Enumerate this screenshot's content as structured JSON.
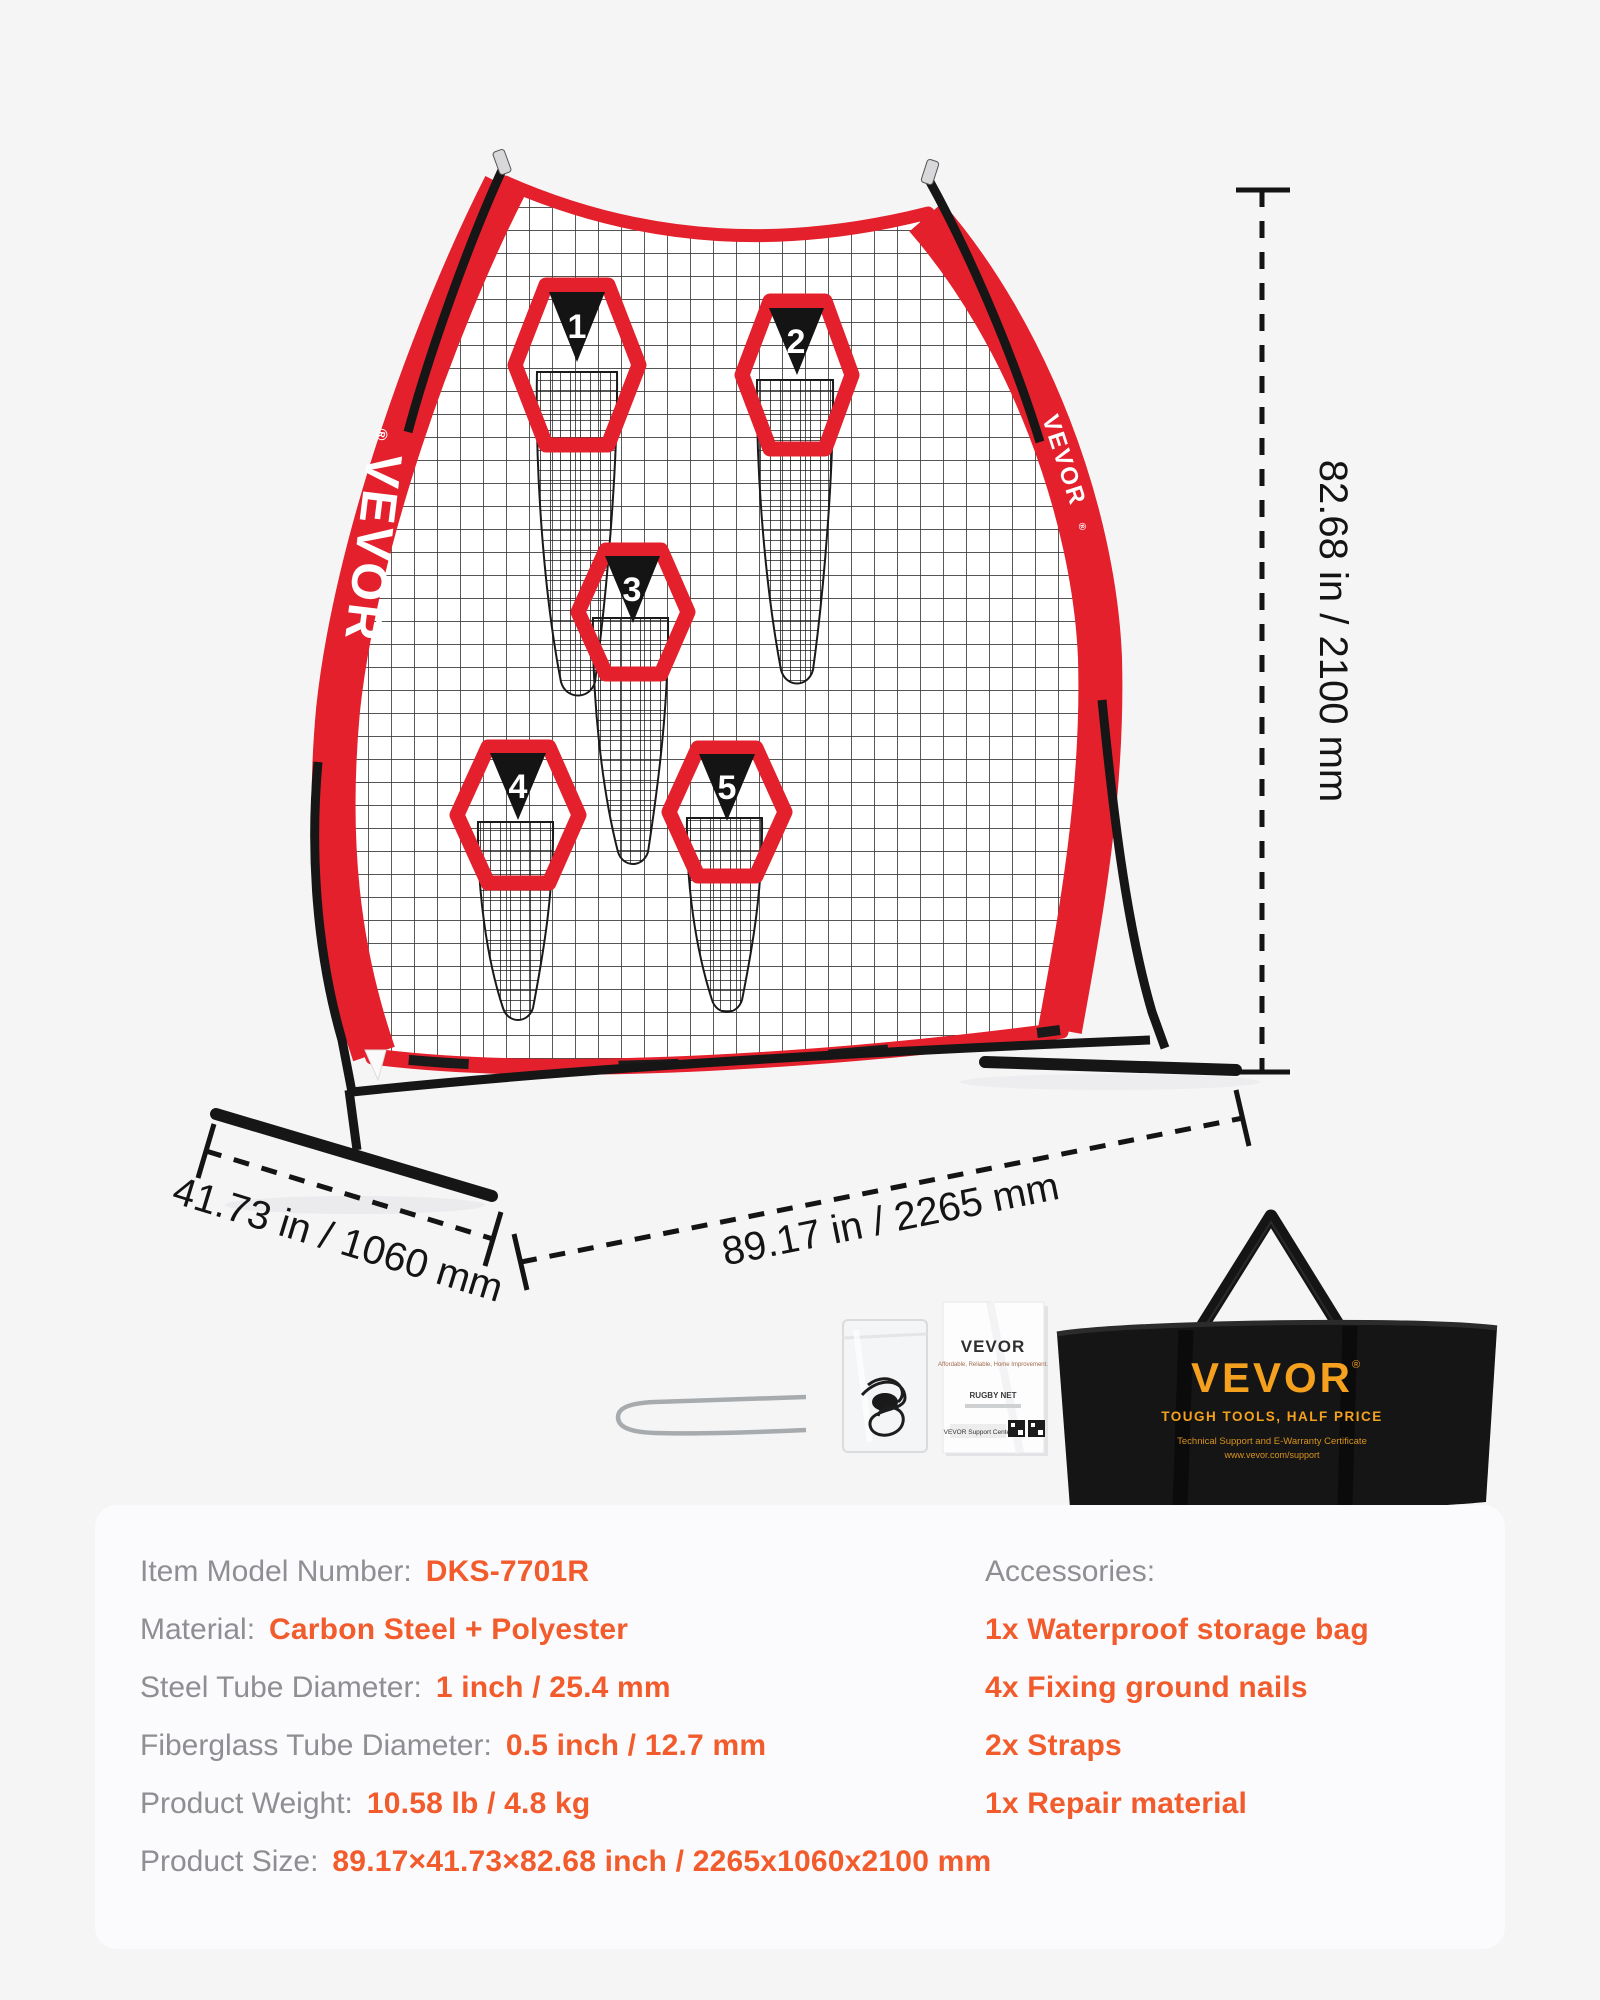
{
  "brand": {
    "name": "VEVOR",
    "registered": "®"
  },
  "net": {
    "targets": [
      "1",
      "2",
      "3",
      "4",
      "5"
    ]
  },
  "dimension_labels": {
    "height": "82.68 in / 2100 mm",
    "width": "89.17 in / 2265 mm",
    "depth": "41.73 in / 1060 mm"
  },
  "accessories_visual": {
    "manual": {
      "brand": "VEVOR",
      "tagline": "Affordable, Reliable, Home Improvement.",
      "product": "RUGBY NET",
      "support": "VEVOR Support Center"
    },
    "storage_bag": {
      "brand": "VEVOR",
      "registered": "®",
      "slogan": "TOUGH TOOLS, HALF PRICE",
      "line1": "Technical Support and E-Warranty Certificate",
      "line2": "www.vevor.com/support"
    }
  },
  "specs": {
    "rows": [
      {
        "label": "Item Model Number:",
        "value": "DKS-7701R"
      },
      {
        "label": "Material:",
        "value": "Carbon Steel + Polyester"
      },
      {
        "label": "Steel Tube Diameter:",
        "value": "1 inch / 25.4 mm"
      },
      {
        "label": "Fiberglass Tube Diameter:",
        "value": "0.5 inch / 12.7 mm"
      },
      {
        "label": "Product Weight:",
        "value": "10.58 lb / 4.8 kg"
      },
      {
        "label": "Product Size:",
        "value": "89.17×41.73×82.68 inch / 2265x1060x2100 mm"
      }
    ],
    "accessories": {
      "label": "Accessories:",
      "items": [
        "1x Waterproof storage bag",
        "4x Fixing ground nails",
        "2x Straps",
        "1x Repair material"
      ]
    }
  },
  "colors": {
    "net_red": "#E3202C",
    "accent_orange": "#F25B2C",
    "label_gray": "#8E8E93",
    "bag_gold": "#F5A11E",
    "page_background": "#F5F5F6",
    "card_background": "#FBFBFD"
  }
}
